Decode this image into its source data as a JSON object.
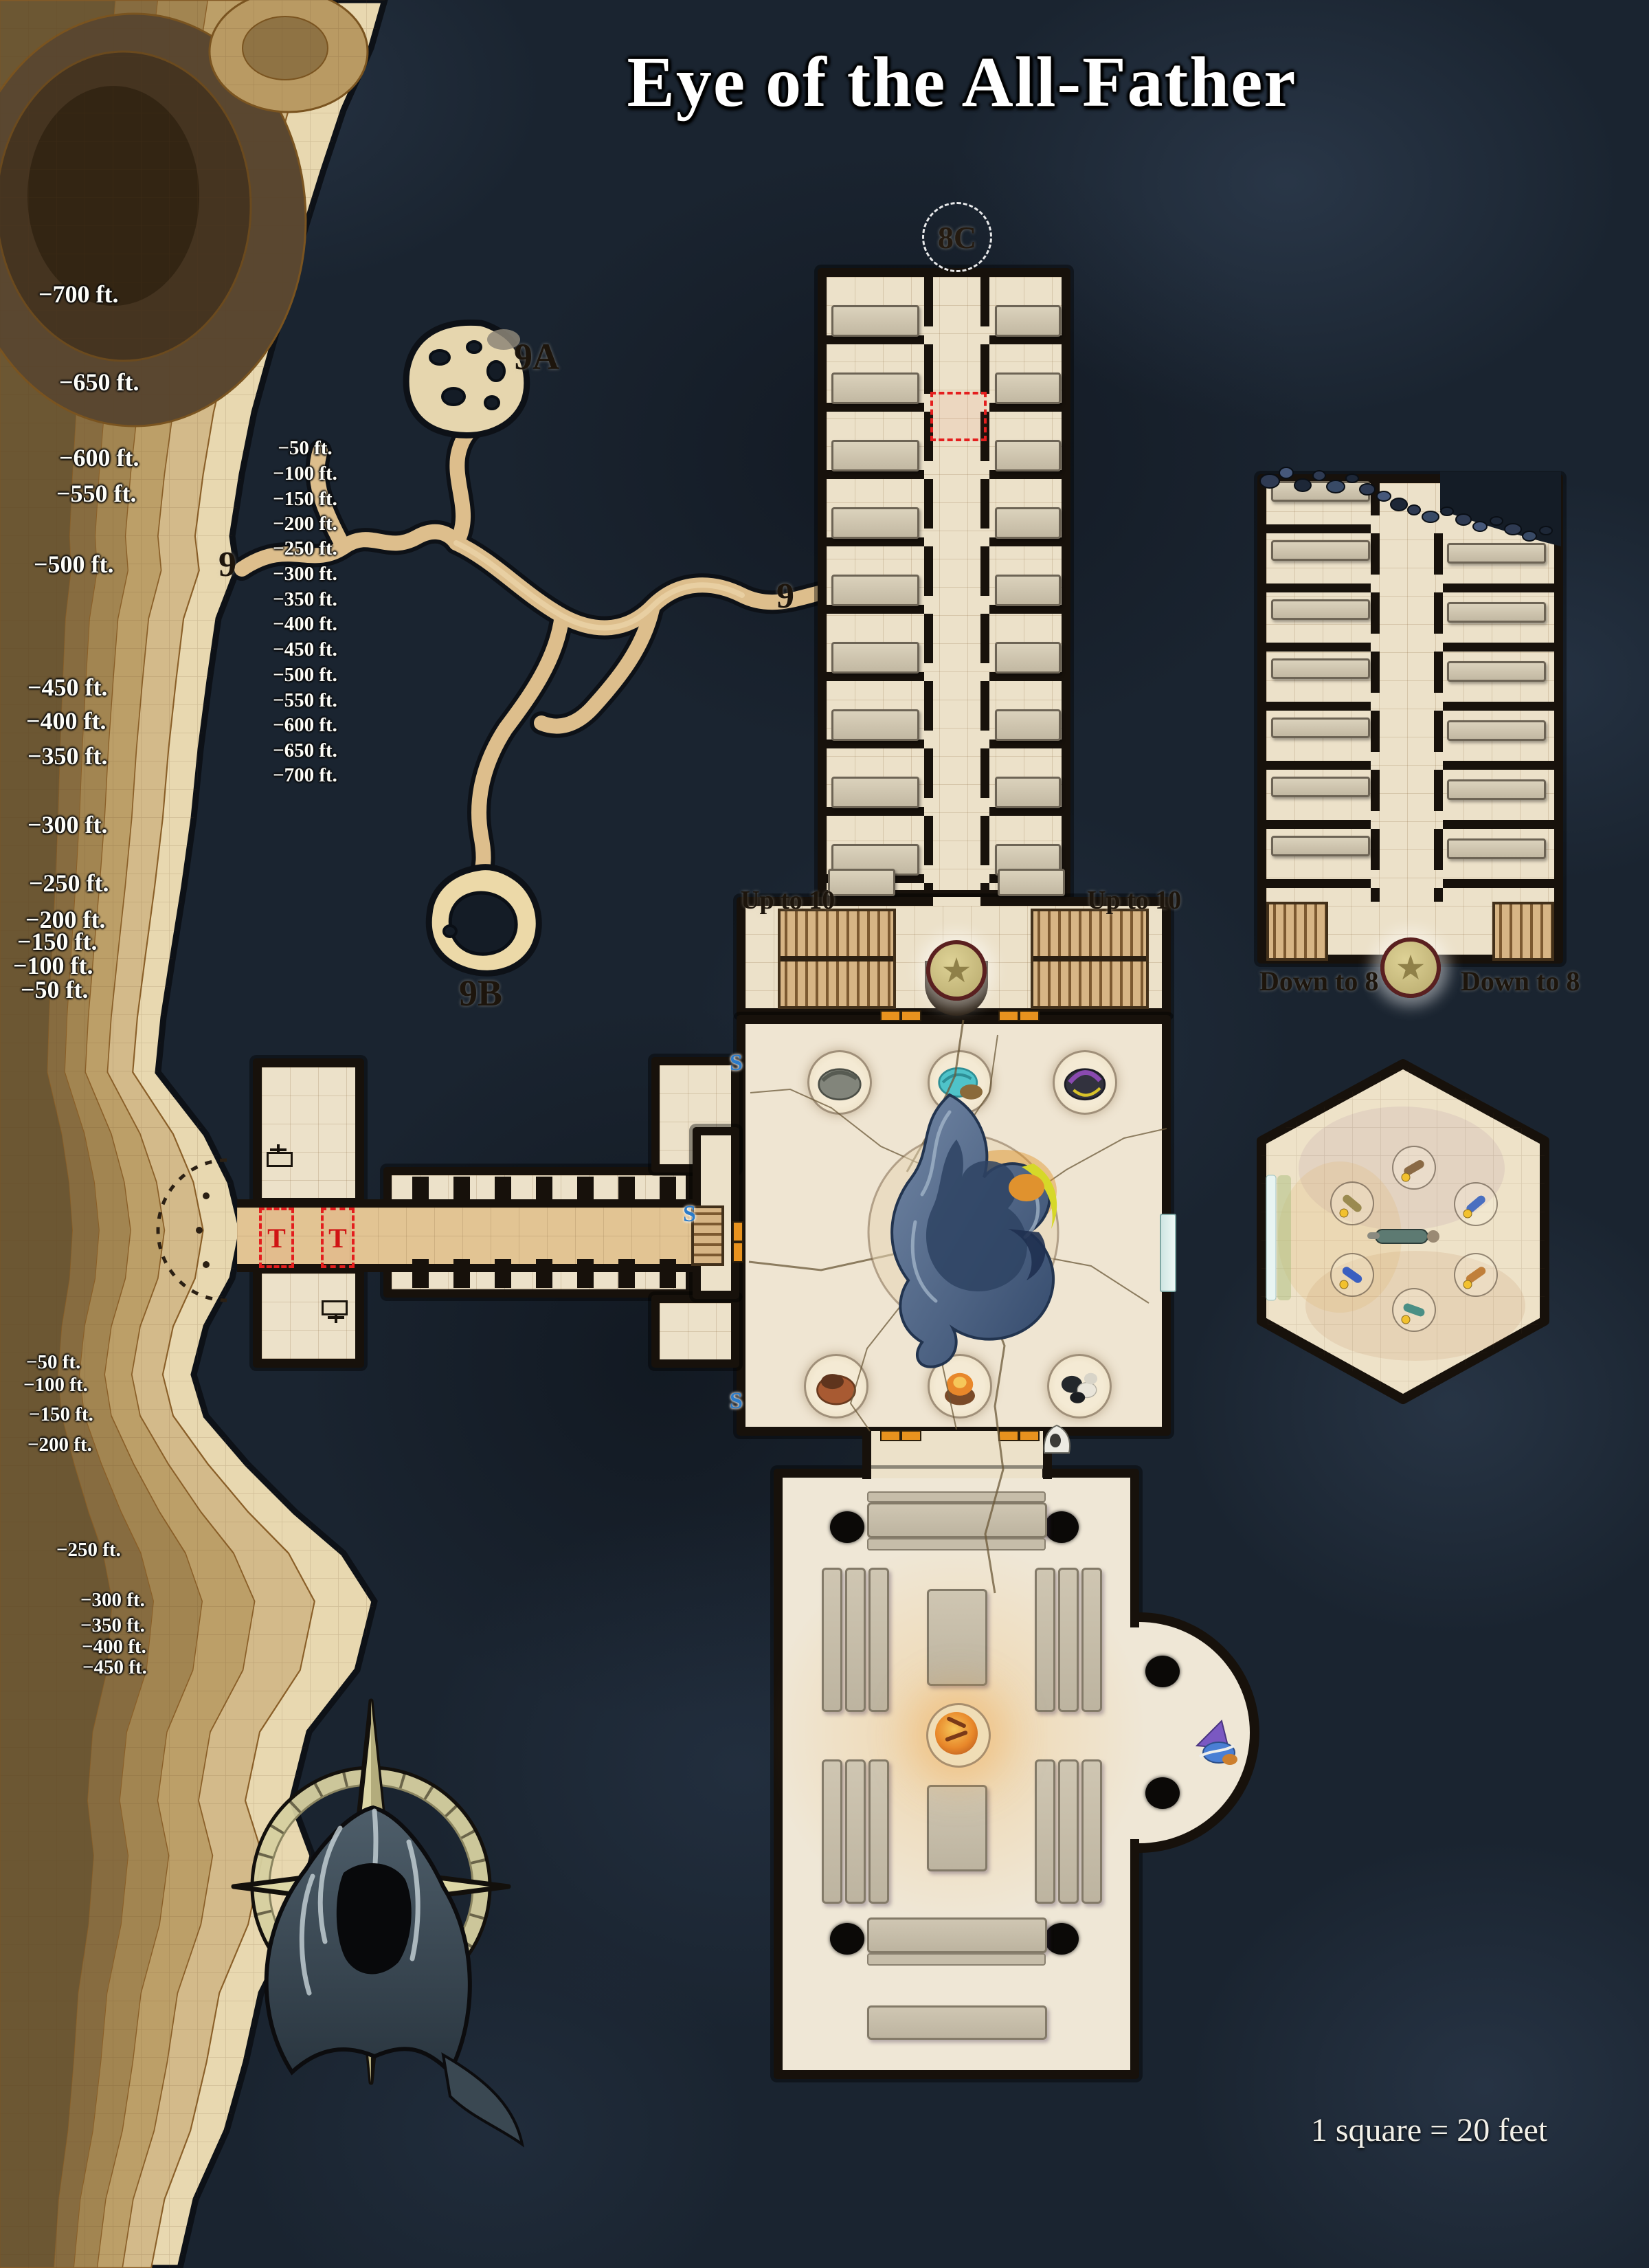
{
  "title": "Eye of the All-Father",
  "scale_note": "1 square = 20 feet",
  "area_labels": {
    "a9a": "9A",
    "w9": "9",
    "e9": "9",
    "b9b": "9B",
    "c8c": "8C"
  },
  "stair_labels": {
    "up_left": "Up to 10",
    "up_right": "Up to 10",
    "down_left": "Down to 8",
    "down_right": "Down to 8"
  },
  "trap_markers": {
    "t1": "T",
    "t2": "T"
  },
  "secret_doors": {
    "s1": "S",
    "s2": "S",
    "s3": "S"
  },
  "elevation": {
    "far_left": [
      "−700 ft.",
      "−650 ft.",
      "−600 ft.",
      "−550 ft.",
      "−500 ft.",
      "−450 ft.",
      "−400 ft.",
      "−350 ft.",
      "−300 ft.",
      "−250 ft.",
      "−200 ft.",
      "−150 ft.",
      "−100 ft.",
      "−50 ft."
    ],
    "mid": [
      "−50 ft.",
      "−100 ft.",
      "−150 ft.",
      "−200 ft.",
      "−250 ft.",
      "−300 ft.",
      "−350 ft.",
      "−400 ft.",
      "−450 ft.",
      "−500 ft.",
      "−550 ft.",
      "−600 ft.",
      "−650 ft.",
      "−700 ft."
    ],
    "lower_left": [
      "−50 ft.",
      "−100 ft.",
      "−150 ft.",
      "−200 ft.",
      "−250 ft.",
      "−300 ft.",
      "−350 ft.",
      "−400 ft.",
      "−450 ft."
    ]
  },
  "colors": {
    "water": "#16202b",
    "parchment": "#ece1c9",
    "wall": "#17110b",
    "sand": "#e2c493",
    "contour_light": "#e8d8b0",
    "contour_dark": "#6c5733",
    "door_orange": "#e8921e",
    "trap_red": "#e41e1e",
    "secret_blue": "#2b7bc9",
    "star_gold": "#cdbf84",
    "fire_orange": "#e8872a",
    "vortex_blue": "#3c5270",
    "compass_gold": "#ddd7a6"
  }
}
